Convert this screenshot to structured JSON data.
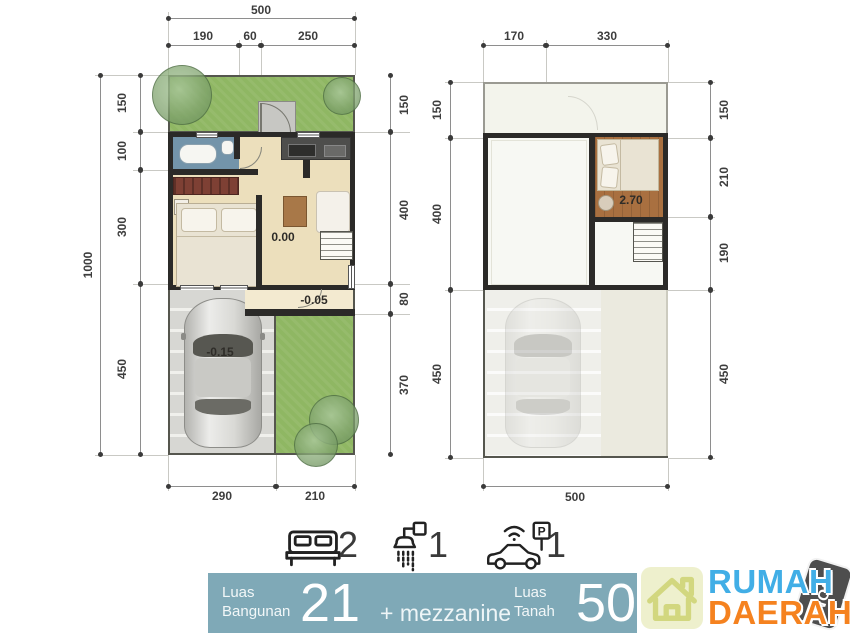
{
  "ground_floor": {
    "levels": {
      "main": "0.00",
      "terrace": "-0.05",
      "carport": "-0.15"
    },
    "dims": {
      "width_total": "500",
      "top": [
        "190",
        "60",
        "250"
      ],
      "height_total": "1000",
      "left": [
        "150",
        "100",
        "300",
        "450"
      ],
      "right": [
        "150",
        "400",
        "80",
        "370"
      ],
      "bottom": [
        "290",
        "210"
      ]
    }
  },
  "mezzanine_floor": {
    "levels": {
      "mezzanine": "2.70"
    },
    "dims": {
      "top": [
        "170",
        "330"
      ],
      "left": [
        "150",
        "400",
        "450"
      ],
      "right": [
        "150",
        "210",
        "190",
        "450"
      ],
      "bottom_total": "500"
    }
  },
  "features": {
    "bedrooms": "2",
    "bathrooms": "1",
    "carports": "1",
    "parking_sign": "P"
  },
  "info_bar": {
    "building_label": [
      "Luas",
      "Bangunan"
    ],
    "building_value": "21",
    "building_suffix": "+ mezzanine",
    "land_label": [
      "Luas",
      "Tanah"
    ],
    "land_value": "50"
  },
  "logo": {
    "word1": "RUMAH",
    "word2": "DAERAH",
    "badge": ".COM"
  },
  "colors": {
    "bar_teal": "#7FA9B7",
    "logo_blue": "#41AEE6",
    "logo_orange": "#F5821F",
    "grass_green": "#8FB763",
    "wood_brown": "#A97040",
    "wall_dark": "#2B2A28"
  }
}
